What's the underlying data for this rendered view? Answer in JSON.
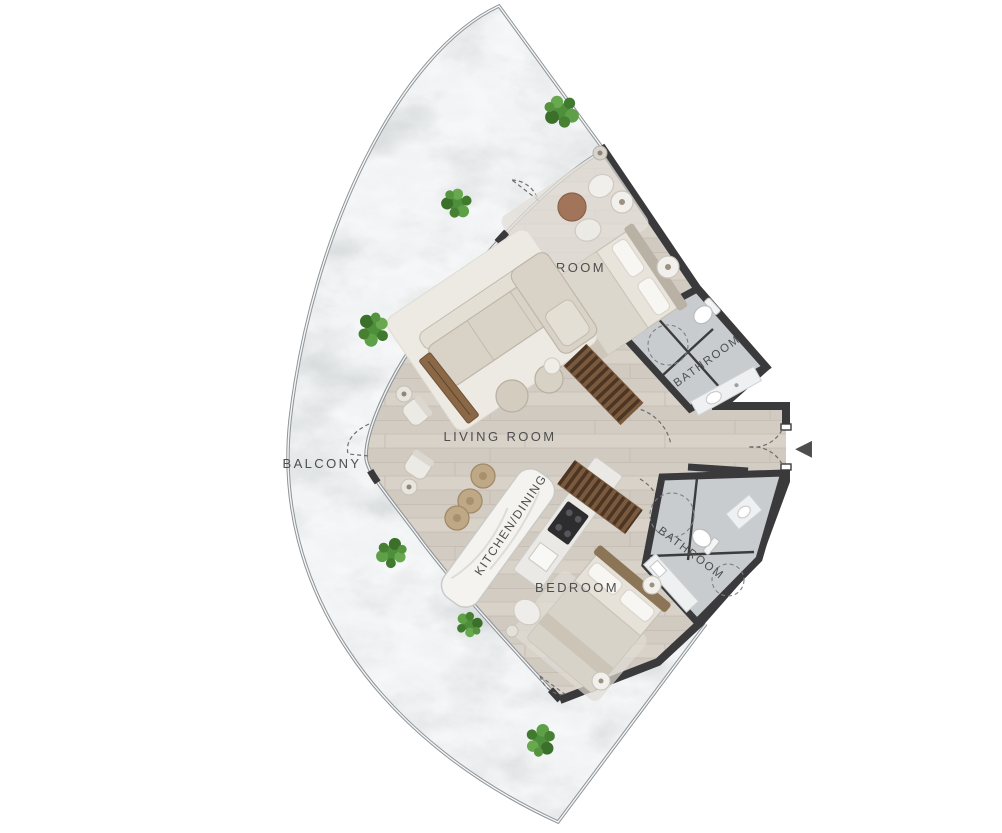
{
  "plan": {
    "type": "apartment-floor-plan",
    "unit_shape": "fan-sector",
    "labels": {
      "balcony": "BALCONY",
      "living_room": "LIVING ROOM",
      "kitchen_dining": "KITCHEN/DINING",
      "bedroom_top": "BEDROOM",
      "bedroom_bottom": "BEDROOM",
      "bathroom_top": "BATHROOM",
      "bathroom_bottom": "BATHROOM"
    },
    "entry": {
      "arrow_glyph": "◀",
      "direction": "left"
    },
    "colors": {
      "walls": "#3a3a3c",
      "interior_floor": "#d6cfc6",
      "balcony_stone": "#ccd1d3",
      "bathroom_tile": "#c8ccce",
      "kitchen_island": "#f4f3f0",
      "wood_furniture": "#7a5a3f",
      "plant_green": "#4e8f3b",
      "label_text": "#4e4e4e"
    }
  }
}
